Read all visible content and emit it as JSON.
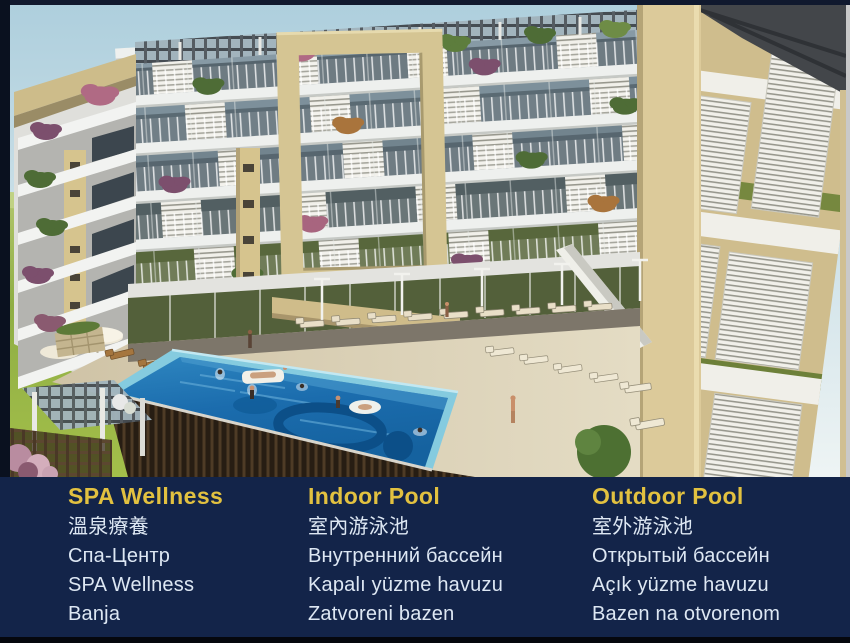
{
  "panel": {
    "columns": [
      {
        "heading": "SPA Wellness",
        "lines": [
          "溫泉療養",
          "Спа-Центр",
          "SPA Wellness",
          "Banja"
        ]
      },
      {
        "heading": "Indoor Pool",
        "lines": [
          "室內游泳池",
          "Внутренний бассейн",
          "Kapalı yüzme havuzu",
          "Zatvoreni bazen"
        ]
      },
      {
        "heading": "Outdoor Pool",
        "lines": [
          "室外游泳池",
          "Открытый бассейн",
          "Açık yüzme havuzu",
          "Bazen na otvorenom"
        ]
      }
    ]
  },
  "colors": {
    "heading_gold": "#e2c140",
    "panel_navy": "#132449",
    "body_text": "#dde7f3",
    "pool_water_blue": "#1b6cad",
    "pool_rim_cyan": "#85cbdf",
    "facade_beige": "#d5c395",
    "lawn_green": "#8fae44"
  }
}
